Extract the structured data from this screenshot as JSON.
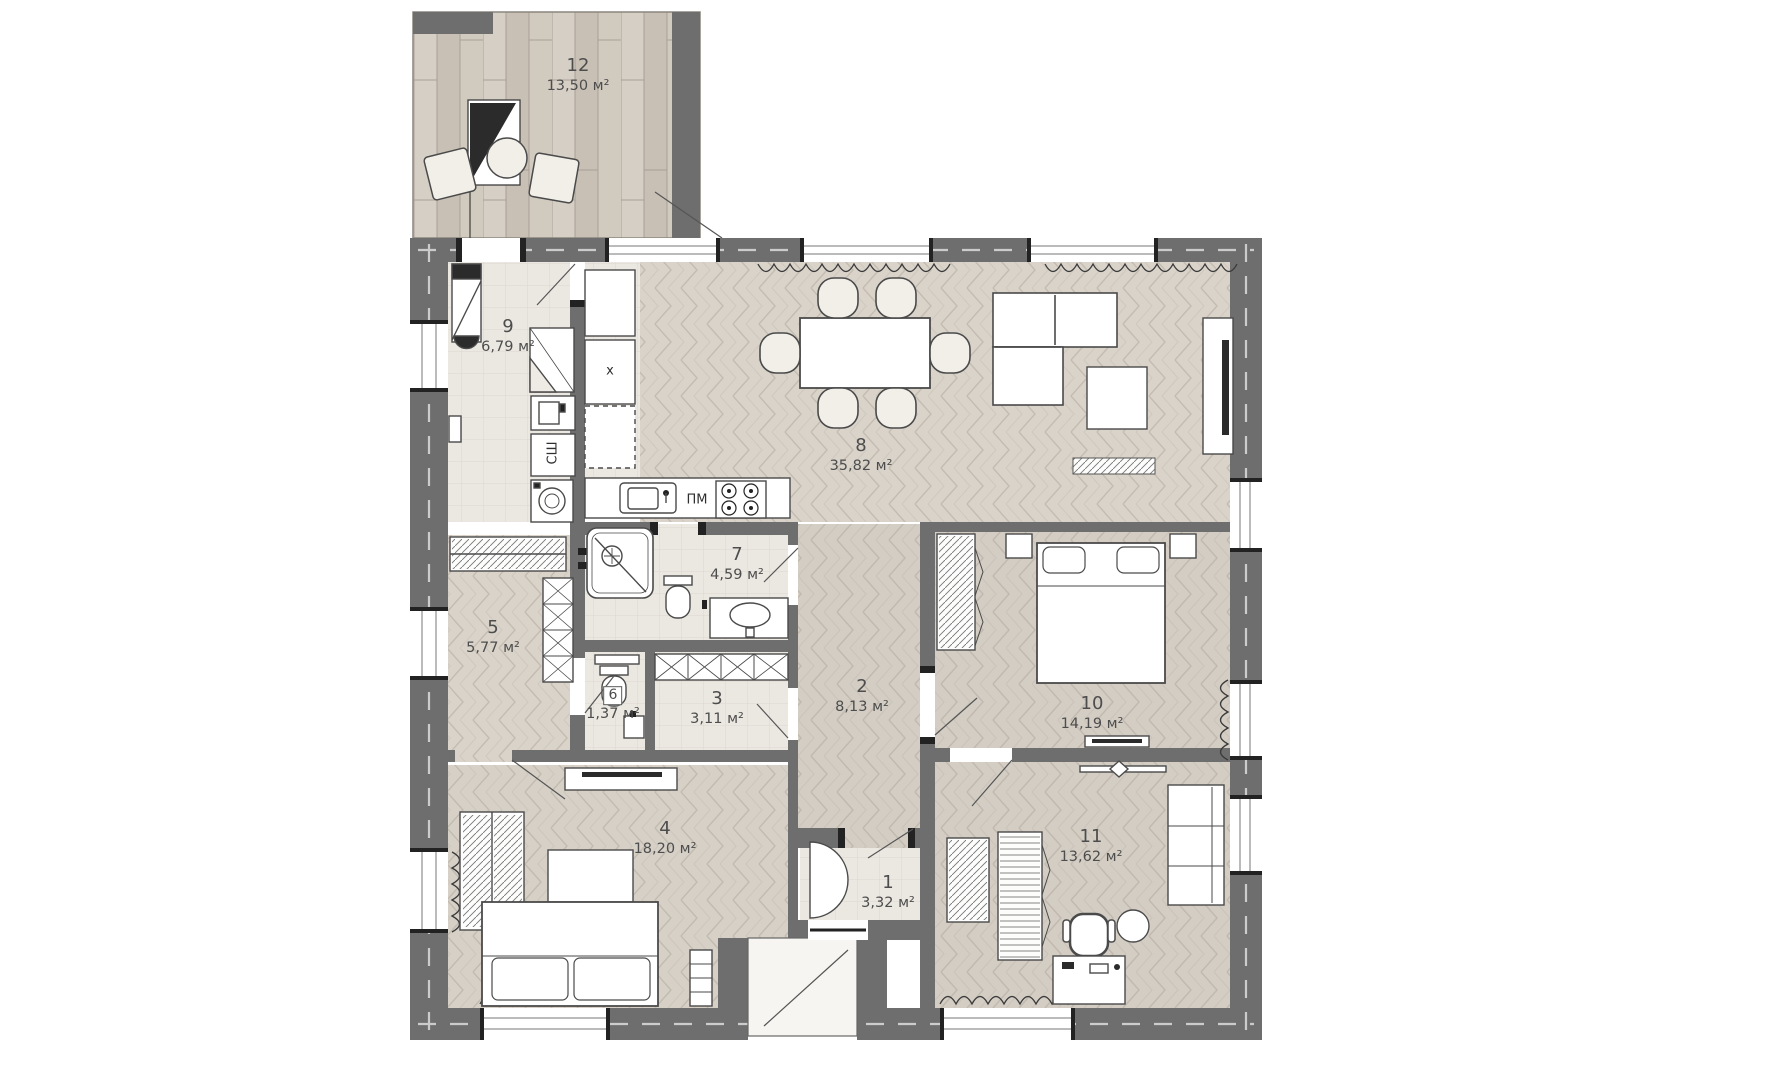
{
  "rooms": [
    {
      "number": "1",
      "area": "3,32 м²"
    },
    {
      "number": "2",
      "area": "8,13 м²"
    },
    {
      "number": "3",
      "area": "3,11 м²"
    },
    {
      "number": "4",
      "area": "18,20 м²"
    },
    {
      "number": "5",
      "area": "5,77 м²"
    },
    {
      "number": "6",
      "area": "1,37 м²"
    },
    {
      "number": "7",
      "area": "4,59 м²"
    },
    {
      "number": "8",
      "area": "35,82 м²"
    },
    {
      "number": "9",
      "area": "6,79 м²"
    },
    {
      "number": "10",
      "area": "14,19 м²"
    },
    {
      "number": "11",
      "area": "13,62 м²"
    },
    {
      "number": "12",
      "area": "13,50 м²"
    }
  ],
  "appliances": {
    "dishwasher_label": "ПМ",
    "dryer_cabinet_label": "СШ",
    "fridge_mark": "x"
  },
  "colors": {
    "wall": "#6e6e6e",
    "floor_wood": "#d9d3ca",
    "floor_tile": "#ebe7e1",
    "terrace_plank": "#cfc8be",
    "furniture_line": "#4a4a4a",
    "label_text": "#4d4d4d"
  }
}
